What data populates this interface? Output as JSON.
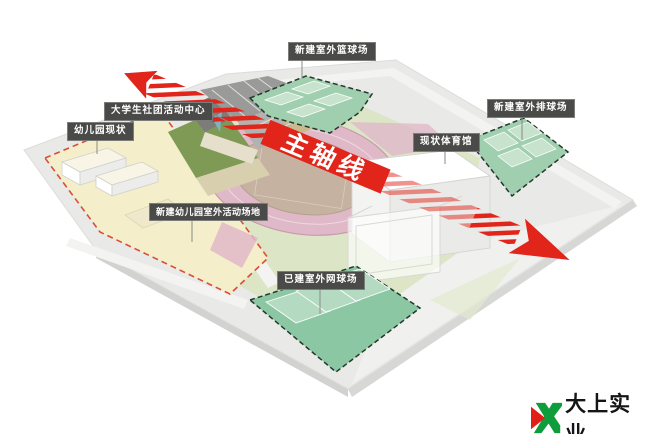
{
  "diagram": {
    "labels": [
      {
        "id": "basketball",
        "text": "新建室外篮球场"
      },
      {
        "id": "volleyball",
        "text": "新建室外排球场"
      },
      {
        "id": "gym",
        "text": "现状体育馆"
      },
      {
        "id": "activity-center",
        "text": "大学生社团活动中心"
      },
      {
        "id": "kindergarten",
        "text": "幼儿园现状"
      },
      {
        "id": "kindergarten-outdoor",
        "text": "新建幼儿园室外活动场地"
      },
      {
        "id": "tennis",
        "text": "已建室外网球场"
      }
    ],
    "axis": {
      "label": "主轴线",
      "color": "#e1251b"
    },
    "colors": {
      "ground": "#e9e9e7",
      "road": "#f3f3f1",
      "grass": "#dce5c6",
      "court_green": "#9fcfae",
      "court_green_light": "#c7e3cd",
      "tennis_green": "#8cc7a4",
      "tennis_green_light": "#b4dbc2",
      "track_pink": "#e0b9c9",
      "field_tan": "#c6b2a0",
      "kindergarten_cream": "#f5eecb",
      "boundary_red": "#d94f35",
      "court_dash_green": "#24382c",
      "label_bg": "#4a4a48"
    }
  },
  "logo": {
    "text": "大上实业",
    "green": "#0f9d3c",
    "red": "#e02018"
  }
}
